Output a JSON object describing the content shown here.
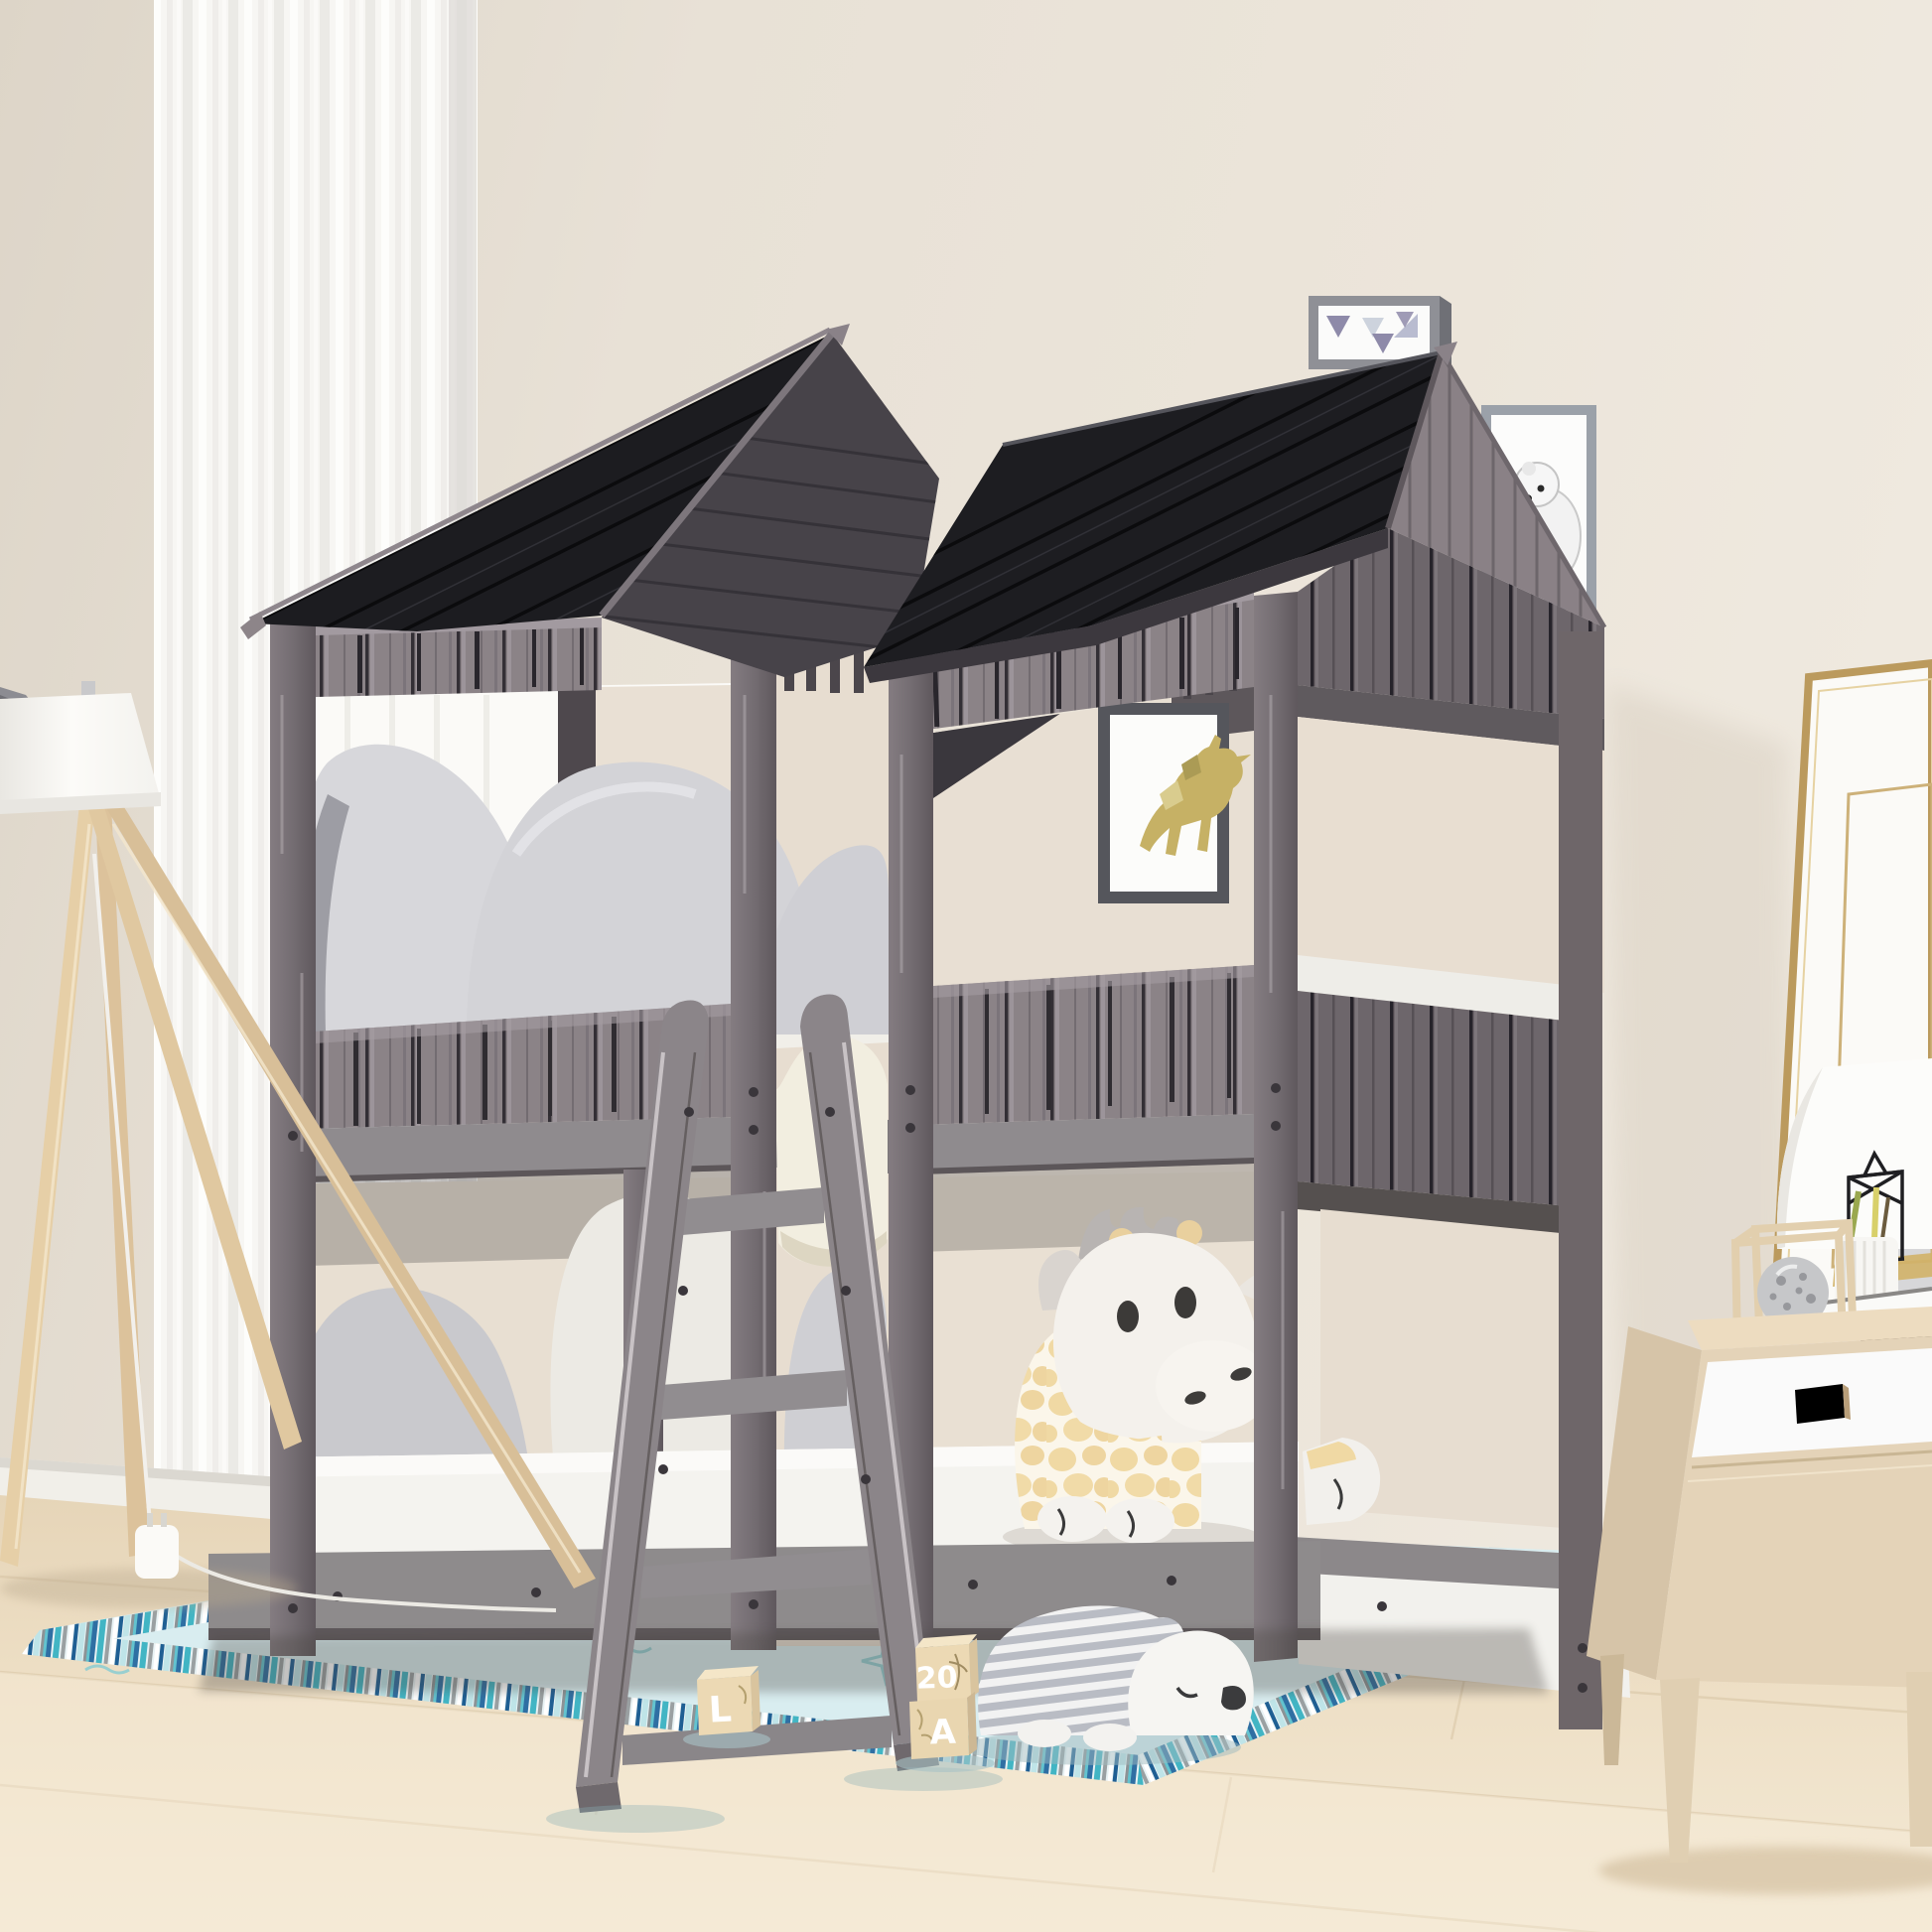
{
  "image_type": "product lifestyle photograph (no UI)",
  "scene": "Kids bedroom with a twin-over-twin house/treehouse style bunk bed in weathered antique gray wood with black plank roofs, angled ladder, plush toys, pastel striped rug, sheer curtain, tripod floor lamp and light-wood nightstand",
  "toy_blocks": {
    "stack_top_label": "20",
    "stack_bottom_label": "A",
    "single_block_label": "L"
  },
  "palette": {
    "wall_beige": "#e8e1d6",
    "wall_left": "#ded6c9",
    "curtain_white": "#f6f5f1",
    "roof_black": "#1c1c20",
    "roof_underside": "#474349",
    "wood_gray": "#8b8387",
    "wood_gray_dark": "#6d666b",
    "beam_gray": "#8f8b8e",
    "mattress_white": "#f4f3ef",
    "pillow_gray": "#d3d3d7",
    "pillow_cream": "#f2eee0",
    "accent_yellow": "#f3cc41",
    "backrest_beige": "#e8dfd2",
    "rug_field": "#d9edf0",
    "rug_fringe_teal": "#42b5c4",
    "floor_wood": "#ecdcc0",
    "baseboard": "#f1efe9",
    "giraffe_tan": "#f0d9a4",
    "bear_stripe_gray": "#b9bcc4",
    "nightstand_wood": "#e4d3b8",
    "drawer_white": "#fafafa",
    "gold_frame": "#bb9a5d",
    "deer_art_gold": "#c6b165"
  },
  "objects": [
    "house-bunk-bed",
    "left-house",
    "right-house",
    "ladder",
    "upper-bunk-pillows",
    "lower-bunk-pillows",
    "giraffe-plush",
    "bear-plush",
    "toy-blocks",
    "area-rug",
    "tripod-floor-lamp",
    "nightstand",
    "wall-art-triangles",
    "wall-art-polar-bear",
    "wall-art-deer",
    "leaning-art-frame",
    "table-lamp-shade",
    "wire-lantern",
    "pencil-cup",
    "books",
    "decor-cube",
    "sheer-curtain",
    "wood-floor",
    "baseboard",
    "wall-hook"
  ]
}
